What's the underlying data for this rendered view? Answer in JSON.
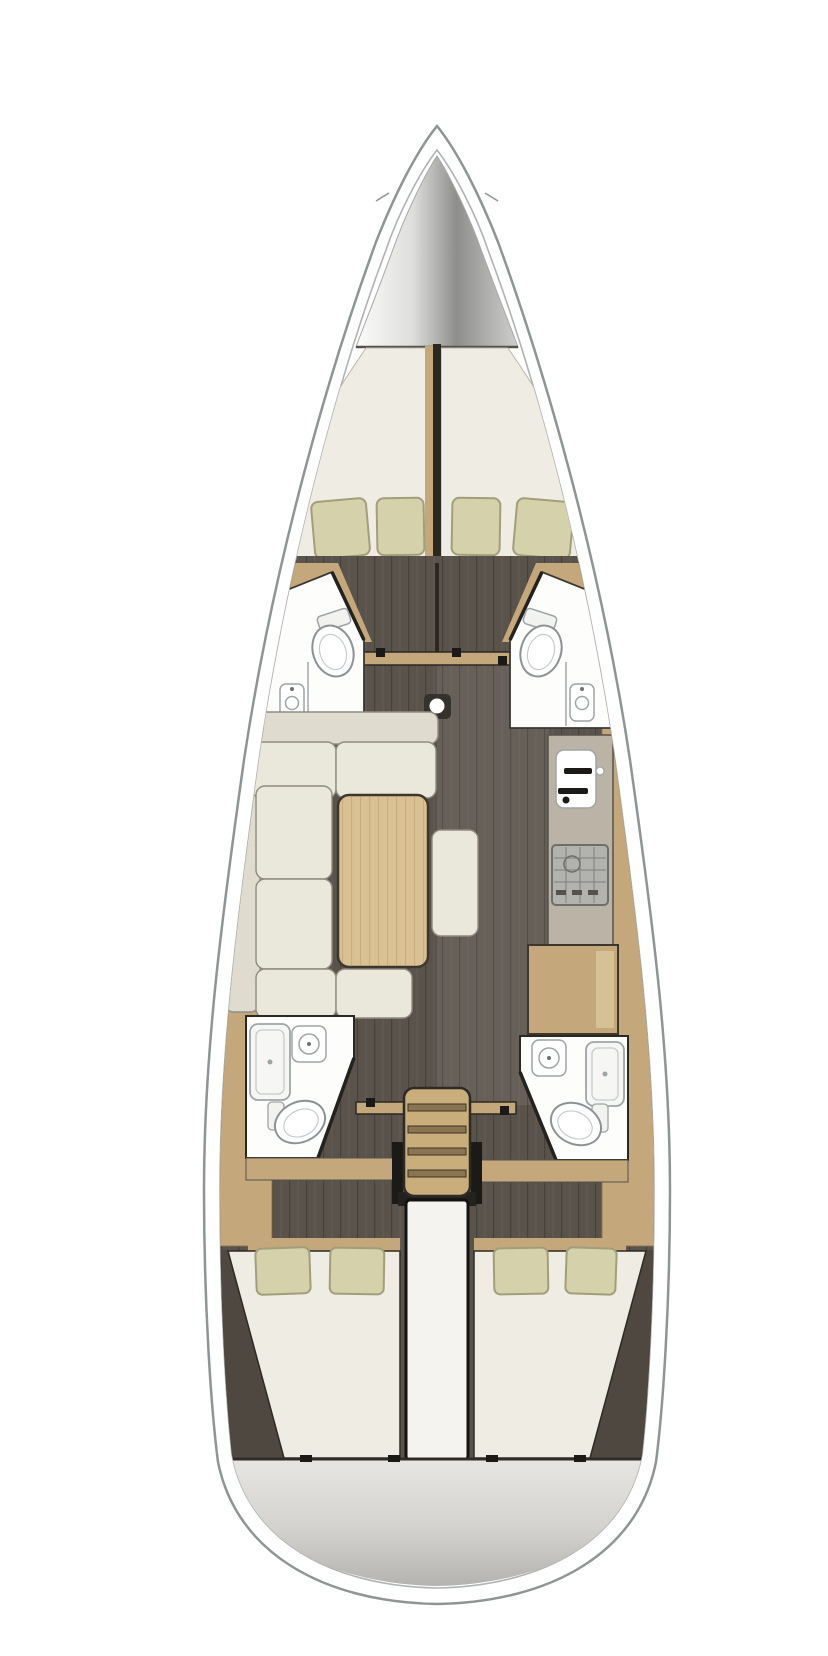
{
  "figure": {
    "type": "sailboat-interior-floorplan-top-view",
    "orientation": "bow-at-top",
    "areas": [
      "anchor-locker",
      "v-berth-forward-cabin",
      "forward-head-port",
      "forward-head-starboard",
      "saloon-with-u-sofa-and-table",
      "galley-with-sink-and-stove",
      "chart-table-desk",
      "aft-head-port-with-shower",
      "aft-head-starboard-with-shower",
      "companionway-stairs",
      "engine-compartment",
      "aft-cabin-port-double-berth",
      "aft-cabin-starboard-double-berth",
      "transom"
    ],
    "counts": {
      "forward_pillows": 2,
      "forward_pillow_pairs": 2,
      "aft_pillows": 4,
      "toilets": 4,
      "bathroom_sinks": 4,
      "shower_pans": 2,
      "stair_steps": 4
    }
  },
  "colors": {
    "hull_stroke": "#8f9494",
    "hull_inner_stroke": "#aeb3b3",
    "deck": "#ffffff",
    "locker_light": "#f5f5f3",
    "locker_dark": "#8e8e8c",
    "bed": "#efede3",
    "pillow": "#d5d1ab",
    "pillow_stroke": "#a29e7b",
    "wood": "#c4a87b",
    "wood_light": "#d6c096",
    "wood_dark": "#8a7352",
    "floor": "#5a534b",
    "cushion": "#eae7db",
    "cushion_back": "#dfdccf",
    "cushion_stroke": "#8f8c80",
    "table": "#d9c193",
    "counter": "#bbb3a5",
    "stove": "#b2b2ae",
    "white_room": "#fdfdfc",
    "fixture_stroke": "#9fa4a6",
    "fixture_light": "#c7cbcd",
    "stairs": "#c9ad7a",
    "step_bar": "#8a7550",
    "engine": "#f4f3ef",
    "transom_light": "#e5e3df",
    "transom_dark": "#bcbab6",
    "dark_line": "#2b2822",
    "hull_corner": "#4f4840",
    "black_fitting": "#1c1a17"
  }
}
